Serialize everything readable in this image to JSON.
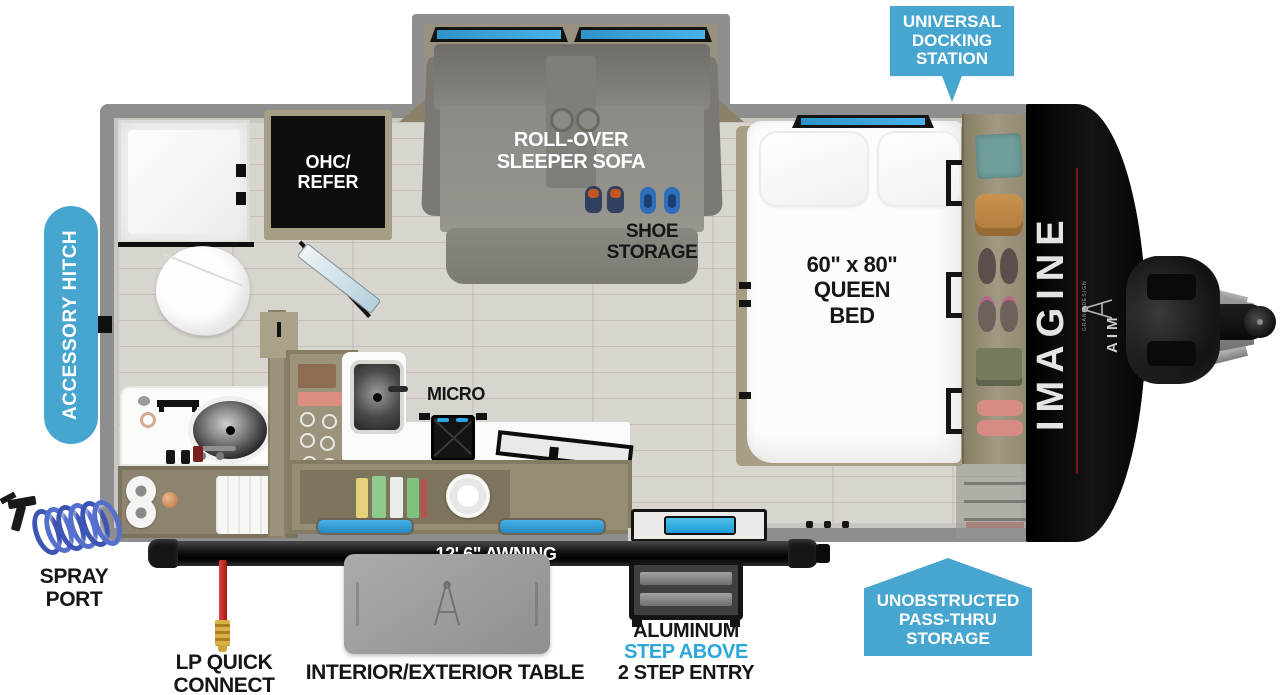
{
  "meta": {
    "description": "Travel trailer floor plan — Imagine AIM"
  },
  "colors": {
    "callout_blue": "#47a6cf",
    "step_above_blue": "#2ba7d9",
    "window_blue": "#49b2e8",
    "label_black": "#161616",
    "cap_black": "#0c0c0c",
    "wall_gray": "#8e8e8e",
    "floor_tan": "#d8d4ce",
    "cabinet_tan": "#968d75",
    "lp_red": "#c32222",
    "brand_red": "#7e1616"
  },
  "callouts": {
    "universal_docking_station": "UNIVERSAL\nDOCKING\nSTATION",
    "accessory_hitch": "ACCESSORY HITCH",
    "unobstructed_pass_thru_storage": "UNOBSTRUCTED\nPASS-THRU\nSTORAGE"
  },
  "labels": {
    "ohc_refer": "OHC/\nREFER",
    "rollover_sleeper_sofa": "ROLL-OVER\nSLEEPER SOFA",
    "shoe_storage": "SHOE\nSTORAGE",
    "queen_bed": "60\" x 80\"\nQUEEN\nBED",
    "micro": "MICRO"
  },
  "exterior": {
    "awning": "12' 6\" AWNING",
    "spray_port": "SPRAY\nPORT",
    "lp_quick_connect": "LP QUICK\nCONNECT",
    "interior_exterior_table": "INTERIOR/EXTERIOR TABLE",
    "entry_aluminum": "ALUMINUM",
    "entry_step_above": "STEP ABOVE",
    "entry_two_step": "2 STEP ENTRY"
  },
  "branding": {
    "model": "IMAGINE",
    "series": "AIM",
    "manufacturer": "GRAND DESIGN"
  }
}
